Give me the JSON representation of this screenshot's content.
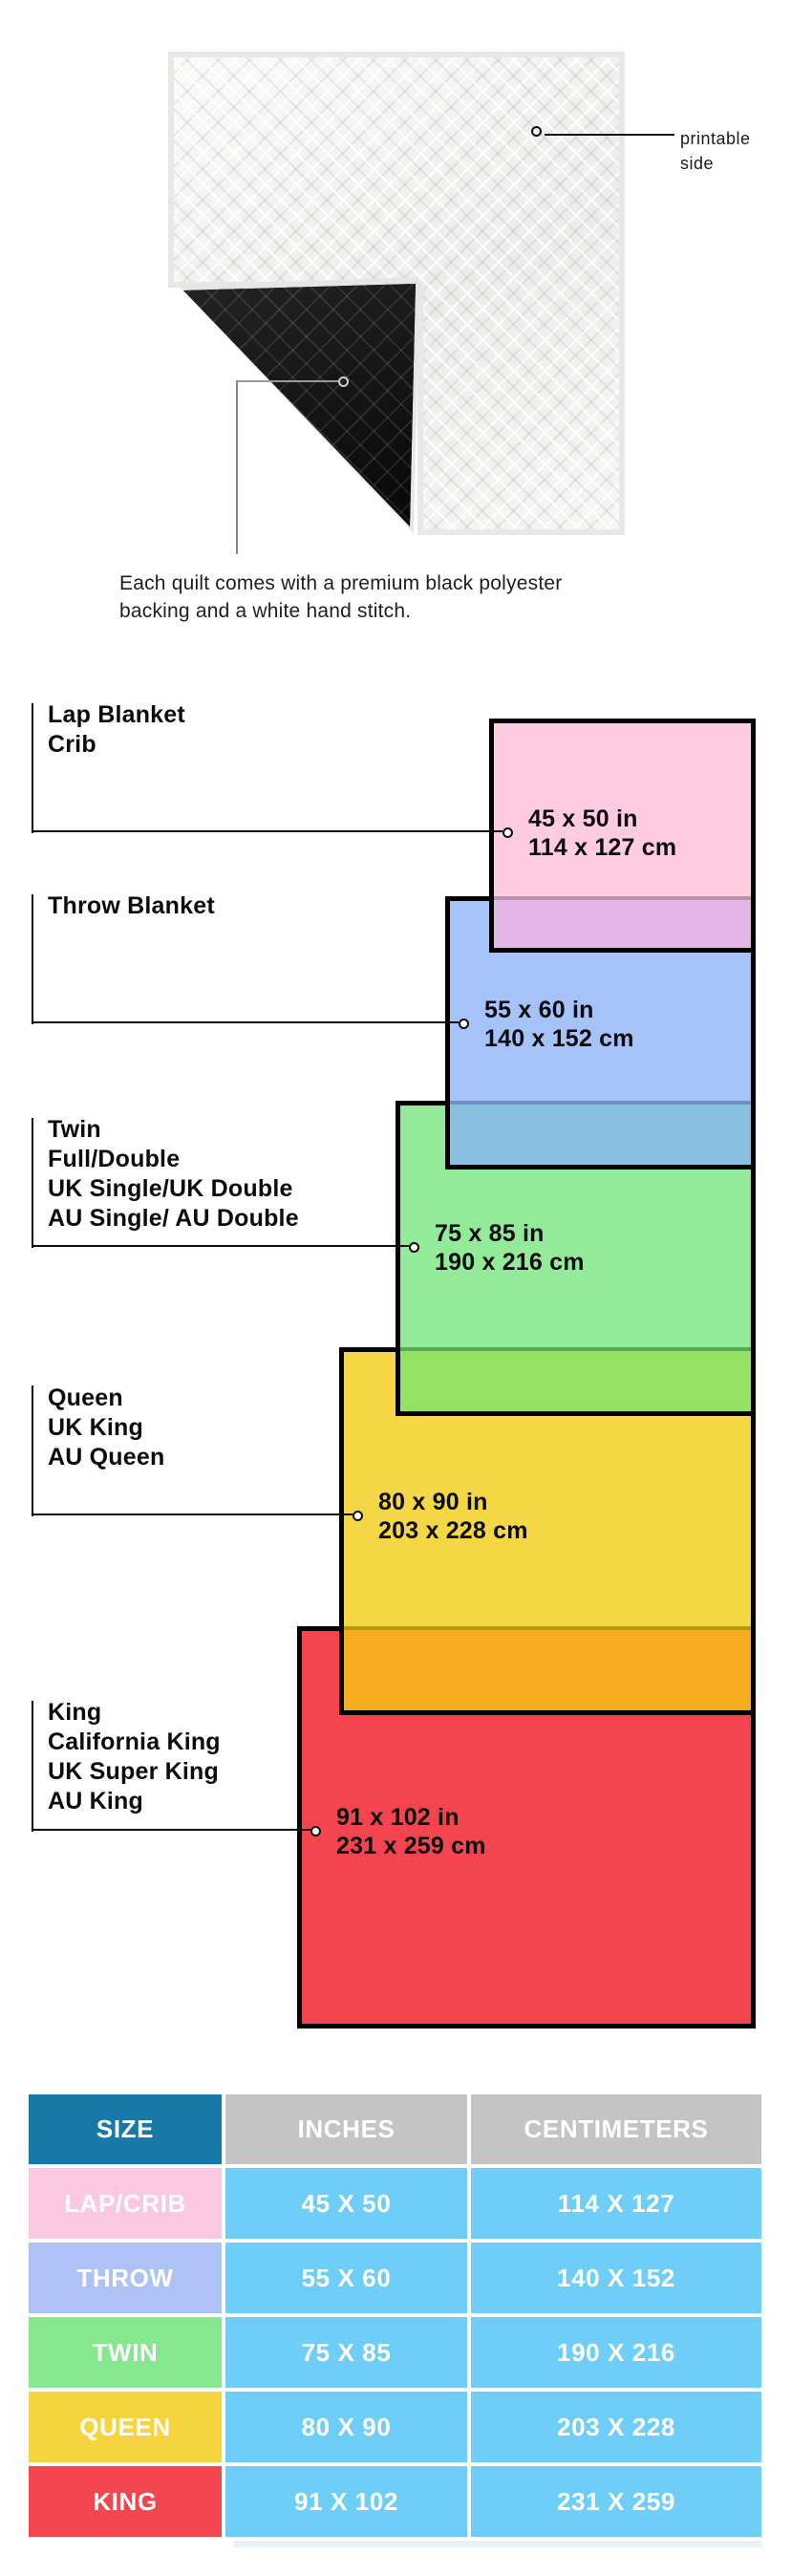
{
  "quilt": {
    "printable_label_line1": "printable",
    "printable_label_line2": "side",
    "caption_line1": "Each quilt comes with a premium black polyester",
    "caption_line2": "backing and a white hand stitch.",
    "colors": {
      "front": "#F2F2F0",
      "backing": "#161616",
      "binding": "#E8E8E6"
    }
  },
  "diagram": {
    "border_color": "#000000",
    "sizes": [
      {
        "key": "lap",
        "names": [
          "Lap Blanket",
          "Crib"
        ],
        "inches": "45 x 50 in",
        "cm": "114 x 127 cm",
        "fill": "#FFCBE1",
        "overlap_fill": "#E3B7E5",
        "overlap_line": "#BE8FA8"
      },
      {
        "key": "throw",
        "names": [
          "Throw Blanket"
        ],
        "inches": "55 x 60 in",
        "cm": "140 x 152 cm",
        "fill": "#A5C3F9",
        "overlap_fill": "#88BEE0",
        "overlap_line": "#6E8FC9"
      },
      {
        "key": "twin",
        "names": [
          "Twin",
          "Full/Double",
          "UK Single/UK Double",
          "AU Single/ AU Double"
        ],
        "inches": "75 x 85 in",
        "cm": "190 x 216 cm",
        "fill": "#93EA98",
        "overlap_fill": "#94E266",
        "overlap_line": "#55A855"
      },
      {
        "key": "queen",
        "names": [
          "Queen",
          "UK King",
          "AU Queen"
        ],
        "inches": "80 x 90 in",
        "cm": "203 x 228 cm",
        "fill": "#F5D745",
        "overlap_fill": "#F5AD1F",
        "overlap_line": "#B39B0E"
      },
      {
        "key": "king",
        "names": [
          "King",
          "California King",
          "UK Super King",
          "AU King"
        ],
        "inches": "91 x 102 in",
        "cm": "231 x 259 cm",
        "fill": "#F4454F"
      }
    ]
  },
  "table": {
    "headers": [
      "SIZE",
      "INCHES",
      "CENTIMETERS"
    ],
    "header_colors": {
      "size_bg": "#1878A8",
      "other_bg": "#C4C4C4",
      "text": "#FFFFFF"
    },
    "value_bg": "#6FCEF7",
    "rows": [
      {
        "size": "LAP/CRIB",
        "size_bg": "#FAC9E1",
        "inches": "45 X 50",
        "cm": "114 X 127"
      },
      {
        "size": "THROW",
        "size_bg": "#AEC2F8",
        "inches": "55 X 60",
        "cm": "140 X 152"
      },
      {
        "size": "TWIN",
        "size_bg": "#85E78E",
        "inches": "75 X 85",
        "cm": "190 X 216"
      },
      {
        "size": "QUEEN",
        "size_bg": "#F5D440",
        "inches": "80 X 90",
        "cm": "203 X 228"
      },
      {
        "size": "KING",
        "size_bg": "#F4464F",
        "inches": "91 X 102",
        "cm": "231 X 259"
      }
    ]
  }
}
